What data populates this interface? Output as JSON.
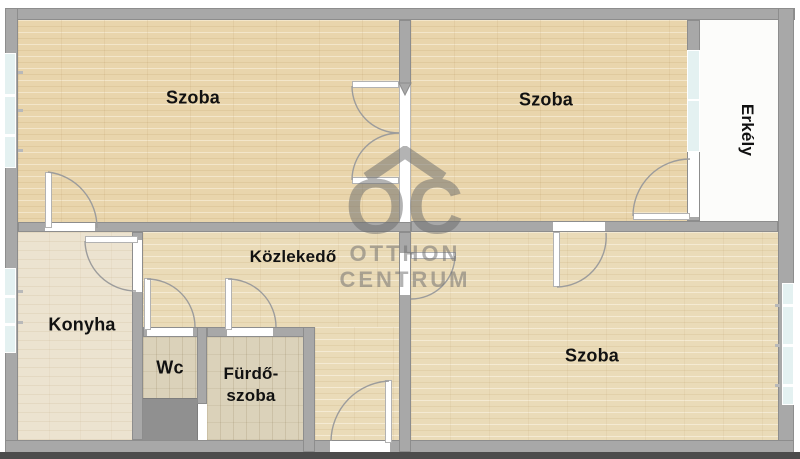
{
  "plan_type": "apartment-floor-plan",
  "rooms": {
    "szoba_top_left": {
      "label": "Szoba"
    },
    "szoba_top_right": {
      "label": "Szoba"
    },
    "szoba_bottom": {
      "label": "Szoba"
    },
    "kozlekedo": {
      "label": "Közlekedő"
    },
    "konyha": {
      "label": "Konyha"
    },
    "wc": {
      "label": "Wc"
    },
    "furdoszoba": {
      "label_line1": "Fürdő-",
      "label_line2": "szoba"
    },
    "erkely": {
      "label": "Erkély"
    }
  },
  "watermark": {
    "monogram": "OC",
    "line1": "OTTHON",
    "line2": "CENTRUM"
  },
  "colors": {
    "wall": "#a8a8a8",
    "wall_outline": "#8d8d8d",
    "wood_floor": "#e9d5ac",
    "kitchen_floor": "#ece3d0",
    "tile_floor": "#dbd2ba",
    "balcony_floor": "#fcfcfa",
    "window_glass": "#e4f1f1",
    "shaft": "#909090",
    "watermark_gray": "#6e6e6e",
    "label_text": "#111111",
    "bottom_shadow": "#4c4c4c"
  }
}
